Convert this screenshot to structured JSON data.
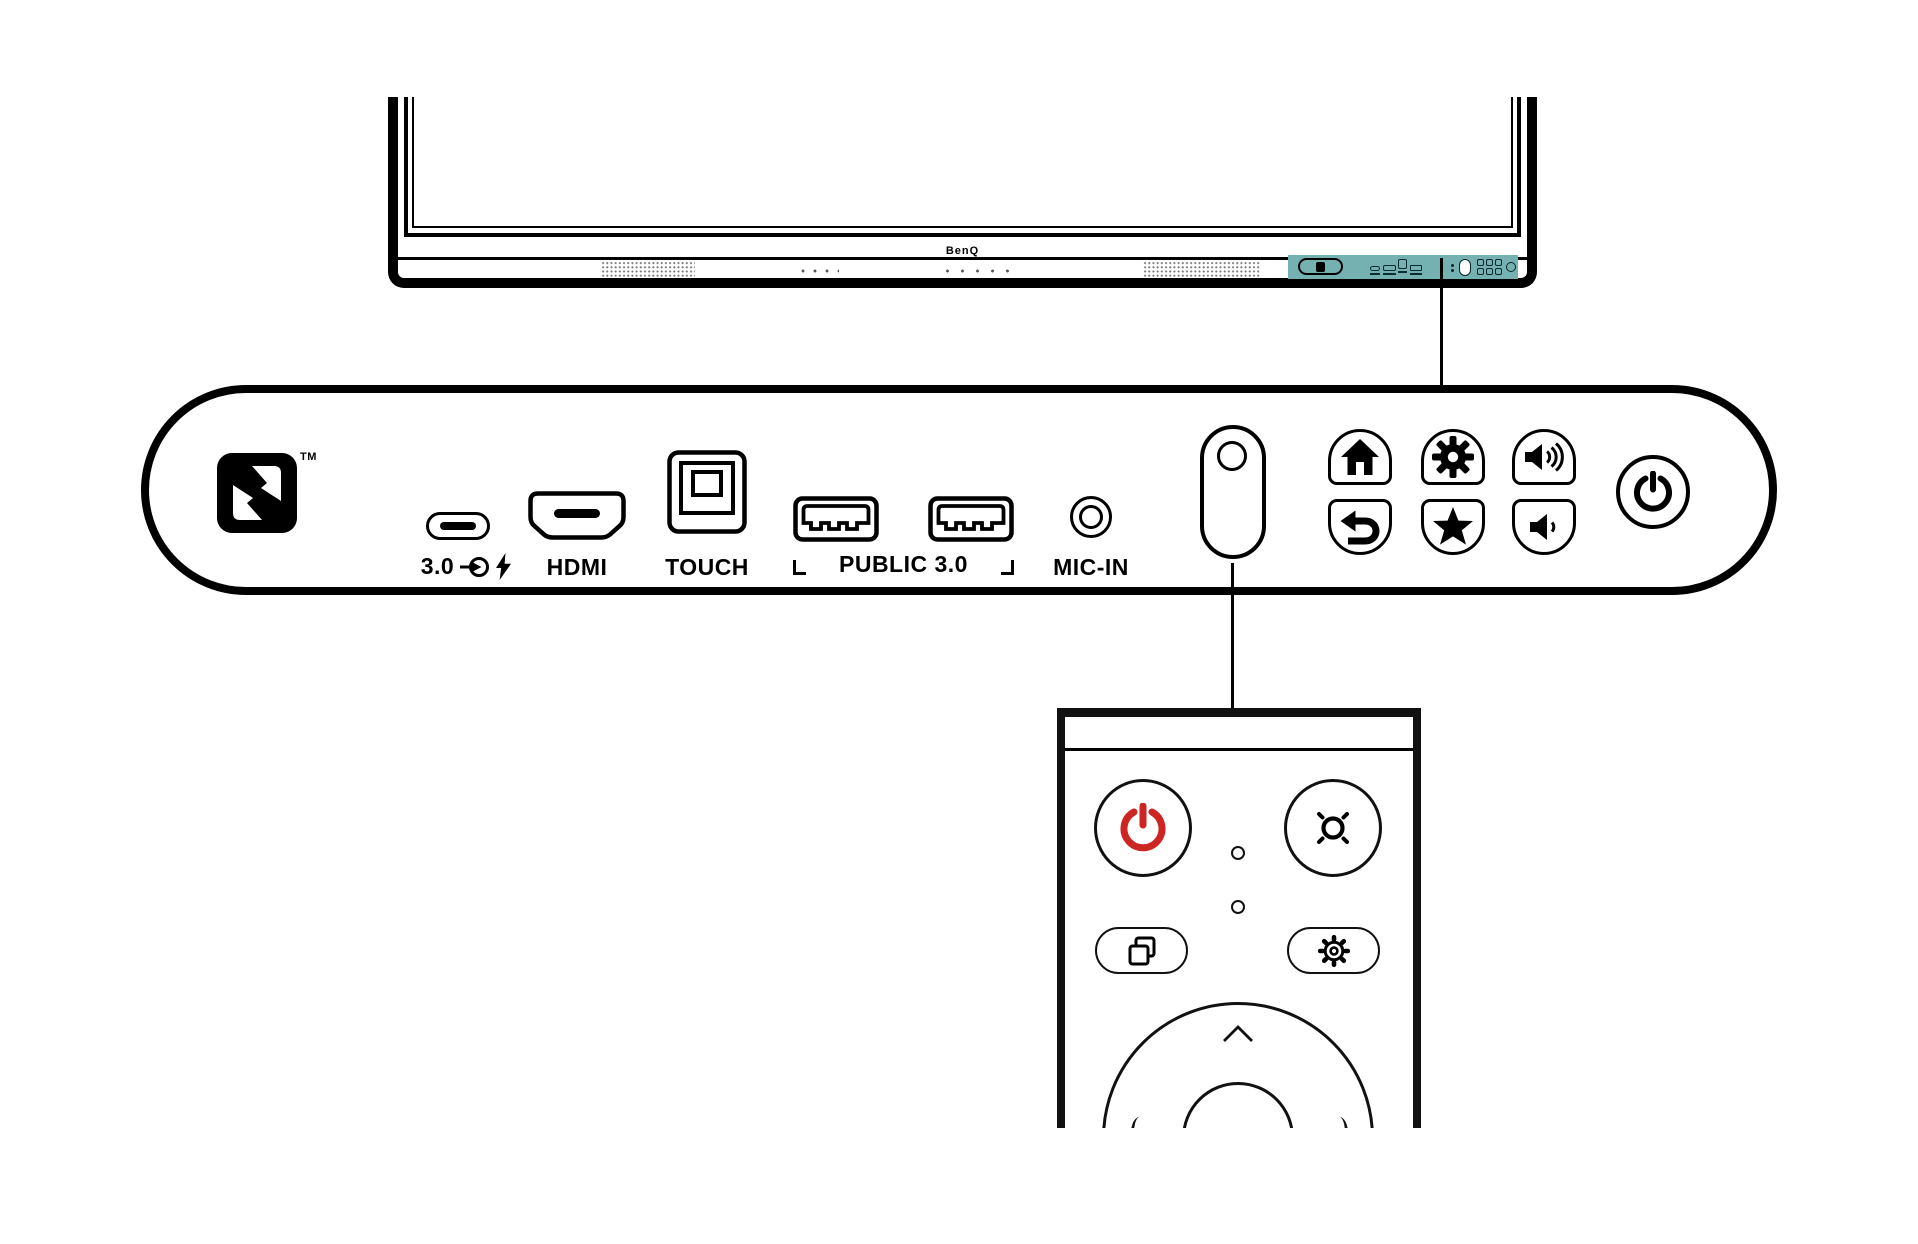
{
  "colors": {
    "highlight_teal": "#76b1b1",
    "remote_power_red": "#cc2522",
    "ink": "#000000"
  },
  "display": {
    "brand": "BenQ",
    "highlight_strip": {
      "icons": [
        "nfc-tag",
        "usb-c-port",
        "hdmi-port",
        "touch-port",
        "usb-port",
        "mic-dots",
        "ir-sensor",
        "button-grid",
        "power"
      ]
    }
  },
  "nfc": {
    "trademark": "TM",
    "icon": "nfc-n-mark"
  },
  "ports": {
    "usb_c": {
      "label": "3.0",
      "icons": [
        "usb-in-icon",
        "quick-charge-icon"
      ]
    },
    "hdmi": {
      "label": "HDMI"
    },
    "touch": {
      "label": "TOUCH"
    },
    "usb_public": {
      "label": "PUBLIC 3.0"
    },
    "mic": {
      "label": "MIC-IN"
    }
  },
  "panel_buttons": [
    {
      "name": "home",
      "icon": "home-icon"
    },
    {
      "name": "settings",
      "icon": "gear-icon"
    },
    {
      "name": "volume-up",
      "icon": "volume-up-icon"
    },
    {
      "name": "back",
      "icon": "back-arrow-icon"
    },
    {
      "name": "favorite",
      "icon": "star-icon"
    },
    {
      "name": "volume-down",
      "icon": "volume-down-icon"
    },
    {
      "name": "power",
      "icon": "power-icon"
    }
  ],
  "sensor": {
    "name": "ir-sensor"
  },
  "remote": {
    "ok_label": "OK",
    "buttons": [
      {
        "name": "power",
        "icon": "power-icon-red"
      },
      {
        "name": "brightness",
        "icon": "brightness-icon"
      },
      {
        "name": "source",
        "icon": "duplicate-windows-icon"
      },
      {
        "name": "settings",
        "icon": "gear-outline-icon"
      },
      {
        "name": "dpad-up",
        "icon": "chevron-up-icon"
      },
      {
        "name": "ok"
      }
    ]
  }
}
